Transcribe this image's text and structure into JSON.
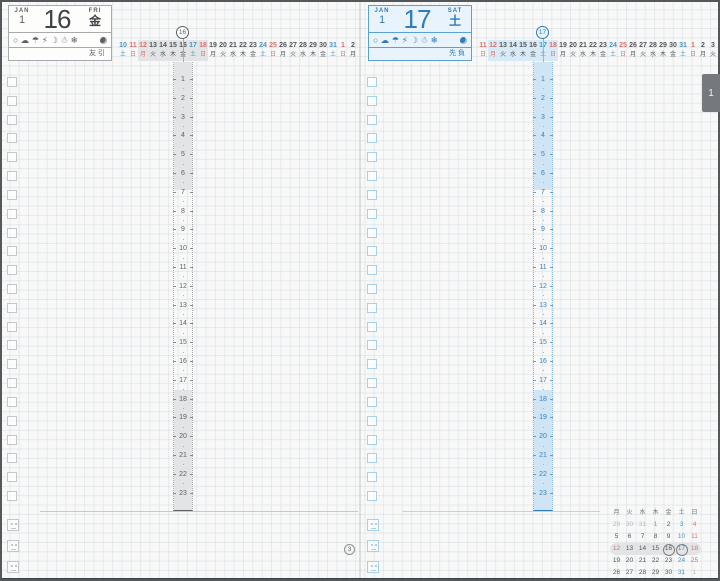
{
  "month_tab": "1",
  "pages": [
    {
      "side": "left",
      "header": {
        "month_label": "JAN",
        "month_number": "1",
        "day_number": "16",
        "weekday_en": "FRI",
        "weekday_kanji": "金",
        "rokuyo": "友引"
      },
      "weather_icons": [
        {
          "name": "sun-icon",
          "glyph": "○"
        },
        {
          "name": "cloud-icon",
          "glyph": "☁"
        },
        {
          "name": "umbrella-icon",
          "glyph": "☂"
        },
        {
          "name": "lightning-icon",
          "glyph": "⚡"
        },
        {
          "name": "crescent-moon-icon",
          "glyph": "☽"
        },
        {
          "name": "snowman-icon",
          "glyph": "☃"
        },
        {
          "name": "snowflake-icon",
          "glyph": "❄"
        }
      ],
      "moon_phase": "waning-crescent",
      "strip": {
        "today_index": 6,
        "today_label": "16",
        "highlight_from": 2,
        "highlight_to": 8,
        "days": [
          {
            "d": "10",
            "w": "土",
            "c": "blue"
          },
          {
            "d": "11",
            "w": "日",
            "c": "red"
          },
          {
            "d": "12",
            "w": "月",
            "c": "red"
          },
          {
            "d": "13",
            "w": "火",
            "c": "ink"
          },
          {
            "d": "14",
            "w": "水",
            "c": "ink"
          },
          {
            "d": "15",
            "w": "木",
            "c": "ink"
          },
          {
            "d": "16",
            "w": "金",
            "c": "ink"
          },
          {
            "d": "17",
            "w": "土",
            "c": "blue"
          },
          {
            "d": "18",
            "w": "日",
            "c": "red"
          },
          {
            "d": "19",
            "w": "月",
            "c": "ink"
          },
          {
            "d": "20",
            "w": "火",
            "c": "ink"
          },
          {
            "d": "21",
            "w": "水",
            "c": "ink"
          },
          {
            "d": "22",
            "w": "木",
            "c": "ink"
          },
          {
            "d": "23",
            "w": "金",
            "c": "ink"
          },
          {
            "d": "24",
            "w": "土",
            "c": "blue"
          },
          {
            "d": "25",
            "w": "日",
            "c": "red"
          },
          {
            "d": "26",
            "w": "月",
            "c": "ink"
          },
          {
            "d": "27",
            "w": "火",
            "c": "ink"
          },
          {
            "d": "28",
            "w": "水",
            "c": "ink"
          },
          {
            "d": "29",
            "w": "木",
            "c": "ink"
          },
          {
            "d": "30",
            "w": "金",
            "c": "ink"
          },
          {
            "d": "31",
            "w": "土",
            "c": "blue"
          },
          {
            "d": "1",
            "w": "日",
            "c": "red"
          },
          {
            "d": "2",
            "w": "月",
            "c": "ink"
          }
        ]
      },
      "hours": [
        "1",
        "2",
        "3",
        "4",
        "5",
        "6",
        "7",
        "8",
        "9",
        "10",
        "11",
        "12",
        "13",
        "14",
        "15",
        "16",
        "17",
        "18",
        "19",
        "20",
        "21",
        "22",
        "23"
      ],
      "checkbox_count": 23
    },
    {
      "side": "right",
      "header": {
        "month_label": "JAN",
        "month_number": "1",
        "day_number": "17",
        "weekday_en": "SAT",
        "weekday_kanji": "土",
        "rokuyo": "先負"
      },
      "weather_icons": [
        {
          "name": "sun-icon",
          "glyph": "○"
        },
        {
          "name": "cloud-icon",
          "glyph": "☁"
        },
        {
          "name": "umbrella-icon",
          "glyph": "☂"
        },
        {
          "name": "lightning-icon",
          "glyph": "⚡"
        },
        {
          "name": "crescent-moon-icon",
          "glyph": "☽"
        },
        {
          "name": "snowman-icon",
          "glyph": "☃"
        },
        {
          "name": "snowflake-icon",
          "glyph": "❄"
        }
      ],
      "moon_phase": "waning-crescent",
      "strip": {
        "today_index": 6,
        "today_label": "17",
        "highlight_from": 1,
        "highlight_to": 7,
        "days": [
          {
            "d": "11",
            "w": "日",
            "c": "red"
          },
          {
            "d": "12",
            "w": "月",
            "c": "red"
          },
          {
            "d": "13",
            "w": "火",
            "c": "ink"
          },
          {
            "d": "14",
            "w": "水",
            "c": "ink"
          },
          {
            "d": "15",
            "w": "木",
            "c": "ink"
          },
          {
            "d": "16",
            "w": "金",
            "c": "ink"
          },
          {
            "d": "17",
            "w": "土",
            "c": "blue"
          },
          {
            "d": "18",
            "w": "日",
            "c": "red"
          },
          {
            "d": "19",
            "w": "月",
            "c": "ink"
          },
          {
            "d": "20",
            "w": "火",
            "c": "ink"
          },
          {
            "d": "21",
            "w": "水",
            "c": "ink"
          },
          {
            "d": "22",
            "w": "木",
            "c": "ink"
          },
          {
            "d": "23",
            "w": "金",
            "c": "ink"
          },
          {
            "d": "24",
            "w": "土",
            "c": "blue"
          },
          {
            "d": "25",
            "w": "日",
            "c": "red"
          },
          {
            "d": "26",
            "w": "月",
            "c": "ink"
          },
          {
            "d": "27",
            "w": "火",
            "c": "ink"
          },
          {
            "d": "28",
            "w": "水",
            "c": "ink"
          },
          {
            "d": "29",
            "w": "木",
            "c": "ink"
          },
          {
            "d": "30",
            "w": "金",
            "c": "ink"
          },
          {
            "d": "31",
            "w": "土",
            "c": "blue"
          },
          {
            "d": "1",
            "w": "日",
            "c": "red"
          },
          {
            "d": "2",
            "w": "月",
            "c": "ink"
          },
          {
            "d": "3",
            "w": "火",
            "c": "ink"
          }
        ]
      },
      "hours": [
        "1",
        "2",
        "3",
        "4",
        "5",
        "6",
        "7",
        "8",
        "9",
        "10",
        "11",
        "12",
        "13",
        "14",
        "15",
        "16",
        "17",
        "18",
        "19",
        "20",
        "21",
        "22",
        "23"
      ],
      "checkbox_count": 23,
      "mini_calendar": {
        "weekday_header": [
          {
            "t": "月",
            "c": "ink"
          },
          {
            "t": "火",
            "c": "ink"
          },
          {
            "t": "水",
            "c": "ink"
          },
          {
            "t": "木",
            "c": "ink"
          },
          {
            "t": "金",
            "c": "ink"
          },
          {
            "t": "土",
            "c": "blue"
          },
          {
            "t": "日",
            "c": "red"
          }
        ],
        "rows": [
          {
            "highlight": false,
            "cells": [
              {
                "d": "29",
                "c": "dim"
              },
              {
                "d": "30",
                "c": "dim"
              },
              {
                "d": "31",
                "c": "dim"
              },
              {
                "d": "1",
                "c": "red"
              },
              {
                "d": "2",
                "c": "ink"
              },
              {
                "d": "3",
                "c": "blue"
              },
              {
                "d": "4",
                "c": "red"
              }
            ]
          },
          {
            "highlight": false,
            "cells": [
              {
                "d": "5",
                "c": "ink"
              },
              {
                "d": "6",
                "c": "ink"
              },
              {
                "d": "7",
                "c": "ink"
              },
              {
                "d": "8",
                "c": "ink"
              },
              {
                "d": "9",
                "c": "ink"
              },
              {
                "d": "10",
                "c": "blue"
              },
              {
                "d": "11",
                "c": "red"
              }
            ]
          },
          {
            "highlight": true,
            "cells": [
              {
                "d": "12",
                "c": "red"
              },
              {
                "d": "13",
                "c": "ink"
              },
              {
                "d": "14",
                "c": "ink"
              },
              {
                "d": "15",
                "c": "ink"
              },
              {
                "d": "16",
                "c": "ink",
                "circled": true
              },
              {
                "d": "17",
                "c": "blue",
                "circled": true
              },
              {
                "d": "18",
                "c": "red"
              }
            ]
          },
          {
            "highlight": false,
            "cells": [
              {
                "d": "19",
                "c": "ink"
              },
              {
                "d": "20",
                "c": "ink"
              },
              {
                "d": "21",
                "c": "ink"
              },
              {
                "d": "22",
                "c": "ink"
              },
              {
                "d": "23",
                "c": "ink"
              },
              {
                "d": "24",
                "c": "blue"
              },
              {
                "d": "25",
                "c": "red"
              }
            ]
          },
          {
            "highlight": false,
            "cells": [
              {
                "d": "26",
                "c": "ink"
              },
              {
                "d": "27",
                "c": "ink"
              },
              {
                "d": "28",
                "c": "ink"
              },
              {
                "d": "29",
                "c": "ink"
              },
              {
                "d": "30",
                "c": "ink"
              },
              {
                "d": "31",
                "c": "blue"
              },
              {
                "d": "1",
                "c": "dim"
              }
            ]
          }
        ],
        "week_badge": "3"
      }
    }
  ]
}
